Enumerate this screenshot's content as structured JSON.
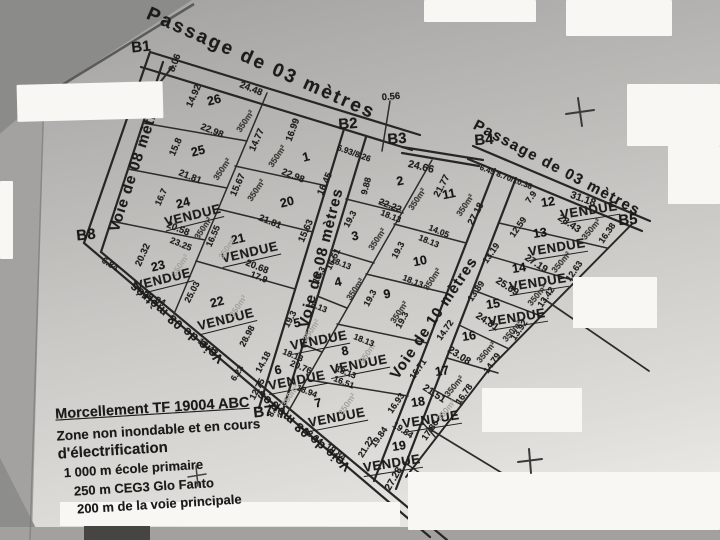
{
  "legend": {
    "sold_label": "VENDUE",
    "area_label": "350m²"
  },
  "info_panel": {
    "title": "Morcellement TF 19004 ABC",
    "line2": "Zone non inondable et en cours",
    "line3": "d'électrification",
    "line4": "1 000 m école primaire",
    "line5": "250 m CEG3 Glo Fanto",
    "line6": "200 m de la voie principale"
  },
  "boundary_markers": [
    {
      "label": "B1",
      "x": 141,
      "y": 47,
      "r": -6
    },
    {
      "label": "B2",
      "x": 348,
      "y": 124,
      "r": -4
    },
    {
      "label": "B3",
      "x": 397,
      "y": 139,
      "r": -4
    },
    {
      "label": "B4",
      "x": 484,
      "y": 140,
      "r": -4
    },
    {
      "label": "B5",
      "x": 628,
      "y": 220,
      "r": -4
    },
    {
      "label": "B7",
      "x": 263,
      "y": 412,
      "r": -6
    },
    {
      "label": "B8",
      "x": 86,
      "y": 235,
      "r": -6
    }
  ],
  "road_labels": [
    {
      "text": "Passage de 03 mètres",
      "x": 261,
      "y": 64,
      "r": 24,
      "s": 19,
      "sp": 2.5
    },
    {
      "text": "Passage de 03 mètres",
      "x": 557,
      "y": 168,
      "r": 28,
      "s": 15,
      "sp": 1.5
    },
    {
      "text": "Voie de 08 mètres",
      "x": 136,
      "y": 163,
      "r": -72,
      "s": 15,
      "sp": 1
    },
    {
      "text": "Voie de 08 mètres",
      "x": 321,
      "y": 258,
      "r": -76,
      "s": 15,
      "sp": 1
    },
    {
      "text": "Voie de 10 mètres",
      "x": 434,
      "y": 318,
      "r": -56,
      "s": 15,
      "sp": 1
    },
    {
      "text": "Voie de 08 mètres",
      "x": 176,
      "y": 323,
      "r": 220,
      "s": 13,
      "sp": 0.5
    },
    {
      "text": "Voie de 08 mètres",
      "x": 303,
      "y": 431,
      "r": 220,
      "s": 13,
      "sp": 0.5
    }
  ],
  "lots": [
    {
      "num": "26",
      "r": -14,
      "nx": 214,
      "ny": 100,
      "ax": 245,
      "ay": 121
    },
    {
      "num": "25",
      "r": -14,
      "nx": 198,
      "ny": 151,
      "ax": 222,
      "ay": 169
    },
    {
      "num": "24",
      "r": -14,
      "nx": 183,
      "ny": 203,
      "vx": 193,
      "vy": 216,
      "ax": 203,
      "ay": 228
    },
    {
      "num": "23",
      "r": -14,
      "nx": 158,
      "ny": 266,
      "vx": 163,
      "vy": 280,
      "ax": 180,
      "ay": 265,
      "af": true
    },
    {
      "num": "22",
      "r": -14,
      "nx": 217,
      "ny": 302,
      "vx": 226,
      "vy": 320,
      "ax": 238,
      "ay": 306,
      "af": true
    },
    {
      "num": "1",
      "r": -14,
      "nx": 306,
      "ny": 157,
      "ax": 277,
      "ay": 156
    },
    {
      "num": "20",
      "r": -14,
      "nx": 287,
      "ny": 202,
      "ax": 256,
      "ay": 190
    },
    {
      "num": "21",
      "r": -13,
      "nx": 238,
      "ny": 239,
      "vx": 250,
      "vy": 253,
      "ax": 227,
      "ay": 248,
      "af": true
    },
    {
      "num": "2",
      "r": -11,
      "nx": 400,
      "ny": 181,
      "ax": 417,
      "ay": 199
    },
    {
      "num": "3",
      "r": -11,
      "nx": 355,
      "ny": 236,
      "ax": 377,
      "ay": 239
    },
    {
      "num": "4",
      "r": -11,
      "nx": 338,
      "ny": 282,
      "ax": 355,
      "ay": 289
    },
    {
      "num": "5",
      "r": -11,
      "nx": 297,
      "ny": 323,
      "vx": 319,
      "vy": 341,
      "ax": 311,
      "ay": 330,
      "af": true
    },
    {
      "num": "6",
      "r": -11,
      "nx": 278,
      "ny": 370,
      "vx": 297,
      "vy": 381,
      "ax": 290,
      "ay": 395,
      "af": true
    },
    {
      "num": "7",
      "r": -11,
      "nx": 318,
      "ny": 403,
      "vx": 337,
      "vy": 418,
      "ax": 347,
      "ay": 404,
      "af": true
    },
    {
      "num": "8",
      "r": -11,
      "nx": 345,
      "ny": 351,
      "vx": 359,
      "vy": 365,
      "ax": 368,
      "ay": 352,
      "af": true
    },
    {
      "num": "9",
      "r": -11,
      "nx": 387,
      "ny": 294,
      "ax": 399,
      "ay": 312
    },
    {
      "num": "10",
      "r": -11,
      "nx": 420,
      "ny": 261,
      "ax": 432,
      "ay": 279
    },
    {
      "num": "11",
      "r": -11,
      "nx": 449,
      "ny": 194,
      "ax": 465,
      "ay": 205
    },
    {
      "num": "12",
      "r": -9,
      "nx": 548,
      "ny": 202,
      "vx": 589,
      "vy": 211,
      "ax": 591,
      "ay": 229,
      "ar": -50
    },
    {
      "num": "13",
      "r": -9,
      "nx": 540,
      "ny": 233,
      "vx": 557,
      "vy": 248,
      "ax": 561,
      "ay": 262,
      "ar": -50
    },
    {
      "num": "14",
      "r": -9,
      "nx": 519,
      "ny": 268,
      "vx": 538,
      "vy": 283,
      "ax": 537,
      "ay": 295,
      "ar": -50
    },
    {
      "num": "15",
      "r": -9,
      "nx": 493,
      "ny": 304,
      "vx": 517,
      "vy": 318,
      "ax": 512,
      "ay": 331,
      "ar": -50
    },
    {
      "num": "16",
      "r": -9,
      "nx": 469,
      "ny": 336,
      "ax": 486,
      "ay": 352,
      "ar": -50
    },
    {
      "num": "17",
      "r": -9,
      "nx": 442,
      "ny": 371,
      "ax": 454,
      "ay": 386,
      "ar": -50
    },
    {
      "num": "18",
      "r": -9,
      "nx": 418,
      "ny": 402,
      "vx": 431,
      "vy": 420,
      "ax": 446,
      "ay": 410,
      "ar": -50,
      "af": true
    },
    {
      "num": "19",
      "r": -9,
      "nx": 399,
      "ny": 446,
      "vx": 392,
      "vy": 464
    }
  ],
  "dimensions": [
    {
      "t": "8.06",
      "x": 175,
      "y": 63,
      "r": -68
    },
    {
      "t": "24.48",
      "x": 251,
      "y": 89,
      "r": 22
    },
    {
      "t": "14.92",
      "x": 194,
      "y": 96,
      "r": -66
    },
    {
      "t": "22.98",
      "x": 212,
      "y": 131,
      "r": 22
    },
    {
      "t": "14.77",
      "x": 257,
      "y": 140,
      "r": -66
    },
    {
      "t": "15.8",
      "x": 176,
      "y": 147,
      "r": -66
    },
    {
      "t": "21.81",
      "x": 190,
      "y": 177,
      "r": 22
    },
    {
      "t": "15.67",
      "x": 238,
      "y": 185,
      "r": -66
    },
    {
      "t": "16.7",
      "x": 161,
      "y": 197,
      "r": -66,
      "s": 9
    },
    {
      "t": "20.58",
      "x": 178,
      "y": 229,
      "r": 22
    },
    {
      "t": "16.55",
      "x": 213,
      "y": 236,
      "r": -66,
      "s": 9
    },
    {
      "t": "20.32",
      "x": 143,
      "y": 255,
      "r": -66
    },
    {
      "t": "23.25",
      "x": 181,
      "y": 244,
      "r": 22,
      "s": 9
    },
    {
      "t": "20.84",
      "x": 154,
      "y": 299,
      "r": 26
    },
    {
      "t": "25.03",
      "x": 192,
      "y": 292,
      "r": -62,
      "s": 9
    },
    {
      "t": "18.42",
      "x": 208,
      "y": 347,
      "r": 38,
      "s": 9
    },
    {
      "t": "28.98",
      "x": 247,
      "y": 336,
      "r": -62,
      "s": 9
    },
    {
      "t": "6.84",
      "x": 110,
      "y": 264,
      "r": 32,
      "s": 9
    },
    {
      "t": "16.99",
      "x": 293,
      "y": 130,
      "r": -70
    },
    {
      "t": "22.98",
      "x": 293,
      "y": 176,
      "r": 22
    },
    {
      "t": "16.45",
      "x": 325,
      "y": 184,
      "r": -66
    },
    {
      "t": "21.81",
      "x": 270,
      "y": 222,
      "r": 22
    },
    {
      "t": "15.63",
      "x": 306,
      "y": 231,
      "r": -66
    },
    {
      "t": "20.68",
      "x": 257,
      "y": 267,
      "r": 22
    },
    {
      "t": "17.9",
      "x": 259,
      "y": 277,
      "r": 22,
      "s": 9
    },
    {
      "t": "16.51",
      "x": 333,
      "y": 259,
      "r": -64,
      "s": 9
    },
    {
      "t": "6.93/8.26",
      "x": 354,
      "y": 153,
      "r": 20,
      "s": 8.5
    },
    {
      "t": "9.88",
      "x": 366,
      "y": 186,
      "r": -75,
      "s": 9
    },
    {
      "t": "0.56",
      "x": 391,
      "y": 97,
      "r": -5
    },
    {
      "t": "24.66",
      "x": 421,
      "y": 167,
      "r": 14,
      "s": 10.5
    },
    {
      "t": "22.22",
      "x": 390,
      "y": 206,
      "r": 22,
      "strike": true
    },
    {
      "t": "18.13",
      "x": 391,
      "y": 216,
      "r": 22,
      "s": 8.5
    },
    {
      "t": "21.77",
      "x": 442,
      "y": 186,
      "r": -62
    },
    {
      "t": "6.45 8.70/10.38",
      "x": 506,
      "y": 177,
      "r": 21,
      "s": 8
    },
    {
      "t": "27.18",
      "x": 476,
      "y": 214,
      "r": -62
    },
    {
      "t": "14.05",
      "x": 439,
      "y": 231,
      "r": 22,
      "s": 8.5
    },
    {
      "t": "18.13",
      "x": 429,
      "y": 241,
      "r": 22,
      "s": 8.5
    },
    {
      "t": "19.3",
      "x": 350,
      "y": 219,
      "r": -62,
      "s": 9
    },
    {
      "t": "18.13",
      "x": 341,
      "y": 263,
      "r": 22,
      "s": 8.5
    },
    {
      "t": "19.3",
      "x": 398,
      "y": 250,
      "r": -62,
      "s": 9
    },
    {
      "t": "18.13",
      "x": 413,
      "y": 281,
      "r": 22,
      "s": 8.5
    },
    {
      "t": "19.3",
      "x": 319,
      "y": 275,
      "r": -62,
      "s": 9
    },
    {
      "t": "18.13",
      "x": 317,
      "y": 306,
      "r": 22,
      "s": 8.5
    },
    {
      "t": "19.3",
      "x": 370,
      "y": 298,
      "r": -62,
      "s": 9
    },
    {
      "t": "19.3",
      "x": 402,
      "y": 320,
      "r": -62,
      "s": 9
    },
    {
      "t": "18.13",
      "x": 364,
      "y": 340,
      "r": 22,
      "s": 8.5
    },
    {
      "t": "19.3",
      "x": 290,
      "y": 319,
      "r": -62,
      "s": 9
    },
    {
      "t": "18.13",
      "x": 293,
      "y": 355,
      "r": 22,
      "s": 8.5
    },
    {
      "t": "20.76",
      "x": 301,
      "y": 367,
      "r": 22,
      "s": 9
    },
    {
      "t": "14.18",
      "x": 263,
      "y": 362,
      "r": -62,
      "s": 9
    },
    {
      "t": "12.75",
      "x": 257,
      "y": 389,
      "r": -62,
      "s": 9
    },
    {
      "t": "18.94",
      "x": 307,
      "y": 391,
      "r": 22,
      "s": 8.5
    },
    {
      "t": "18.13",
      "x": 346,
      "y": 372,
      "r": 22,
      "s": 8.5
    },
    {
      "t": "16.51",
      "x": 344,
      "y": 382,
      "r": 22,
      "s": 8.5
    },
    {
      "t": "18.34",
      "x": 313,
      "y": 436,
      "r": 36,
      "s": 9
    },
    {
      "t": "19.84",
      "x": 336,
      "y": 452,
      "r": 36,
      "s": 9
    },
    {
      "t": "21.22",
      "x": 366,
      "y": 447,
      "r": -58,
      "s": 9
    },
    {
      "t": "6.23",
      "x": 237,
      "y": 373,
      "r": -58,
      "s": 8.5
    },
    {
      "t": "8.92",
      "x": 274,
      "y": 409,
      "r": -58,
      "s": 8.5
    },
    {
      "t": "7.9",
      "x": 531,
      "y": 197,
      "r": -55,
      "s": 9
    },
    {
      "t": "31.18",
      "x": 583,
      "y": 199,
      "r": 20,
      "s": 10.5
    },
    {
      "t": "28.43",
      "x": 569,
      "y": 224,
      "r": 33,
      "s": 10
    },
    {
      "t": "16.38",
      "x": 607,
      "y": 233,
      "r": -55,
      "s": 9
    },
    {
      "t": "12.59",
      "x": 518,
      "y": 227,
      "r": -55,
      "s": 9
    },
    {
      "t": "27.19",
      "x": 536,
      "y": 264,
      "r": 33,
      "s": 10
    },
    {
      "t": "12.63",
      "x": 574,
      "y": 271,
      "r": -55,
      "s": 9
    },
    {
      "t": "13.19",
      "x": 491,
      "y": 253,
      "r": -55,
      "s": 9
    },
    {
      "t": "25.69",
      "x": 507,
      "y": 287,
      "r": 33,
      "s": 10
    },
    {
      "t": "13.42",
      "x": 546,
      "y": 297,
      "r": -55,
      "s": 9
    },
    {
      "t": "13.89",
      "x": 476,
      "y": 291,
      "r": -55,
      "s": 9
    },
    {
      "t": "24.81",
      "x": 487,
      "y": 322,
      "r": 33,
      "s": 10
    },
    {
      "t": "13.92",
      "x": 519,
      "y": 330,
      "r": -55,
      "s": 9
    },
    {
      "t": "14.72",
      "x": 445,
      "y": 330,
      "r": -55,
      "s": 9
    },
    {
      "t": "23.08",
      "x": 459,
      "y": 356,
      "r": 33,
      "s": 10
    },
    {
      "t": "14.79",
      "x": 492,
      "y": 363,
      "r": -55,
      "s": 9
    },
    {
      "t": "16.71",
      "x": 418,
      "y": 369,
      "r": -55,
      "s": 9
    },
    {
      "t": "21.51",
      "x": 434,
      "y": 394,
      "r": 33,
      "s": 10
    },
    {
      "t": "16.78",
      "x": 464,
      "y": 394,
      "r": -55,
      "s": 9
    },
    {
      "t": "16.93",
      "x": 396,
      "y": 403,
      "r": -55,
      "s": 9
    },
    {
      "t": "19.84",
      "x": 403,
      "y": 430,
      "r": 33,
      "s": 9
    },
    {
      "t": "17.86",
      "x": 430,
      "y": 430,
      "r": -55,
      "s": 9
    },
    {
      "t": "19.84",
      "x": 379,
      "y": 437,
      "r": -55,
      "s": 9
    },
    {
      "t": "27.28",
      "x": 394,
      "y": 479,
      "r": -60,
      "s": 10
    }
  ]
}
